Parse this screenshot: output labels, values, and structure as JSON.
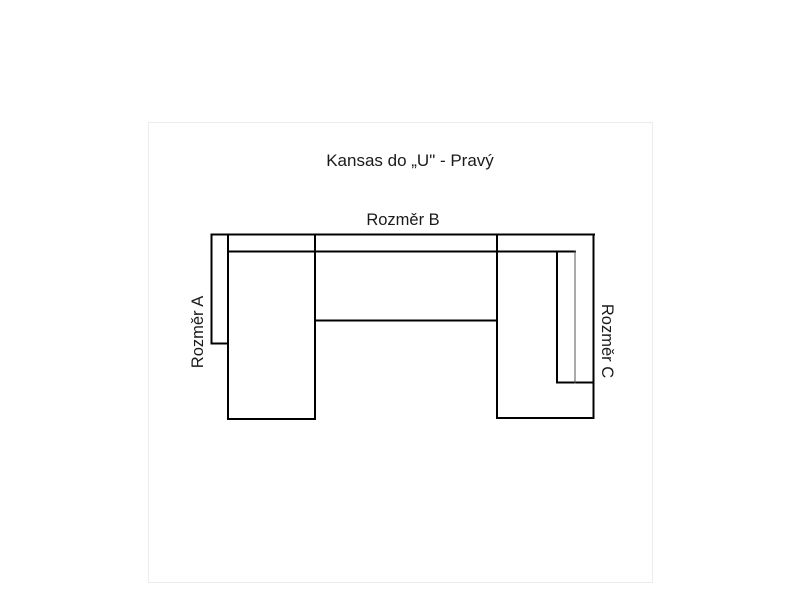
{
  "page": {
    "background_color": "#ffffff",
    "frame_color": "#ececec",
    "text_color": "#1a1a1a"
  },
  "diagram": {
    "title": "Kansas do „U\" - Pravý",
    "line_color": "#000000",
    "thin_line_color": "#555555",
    "labels": {
      "top": "Rozměr B",
      "left": "Rozměr A",
      "right": "Rozměr C"
    }
  }
}
